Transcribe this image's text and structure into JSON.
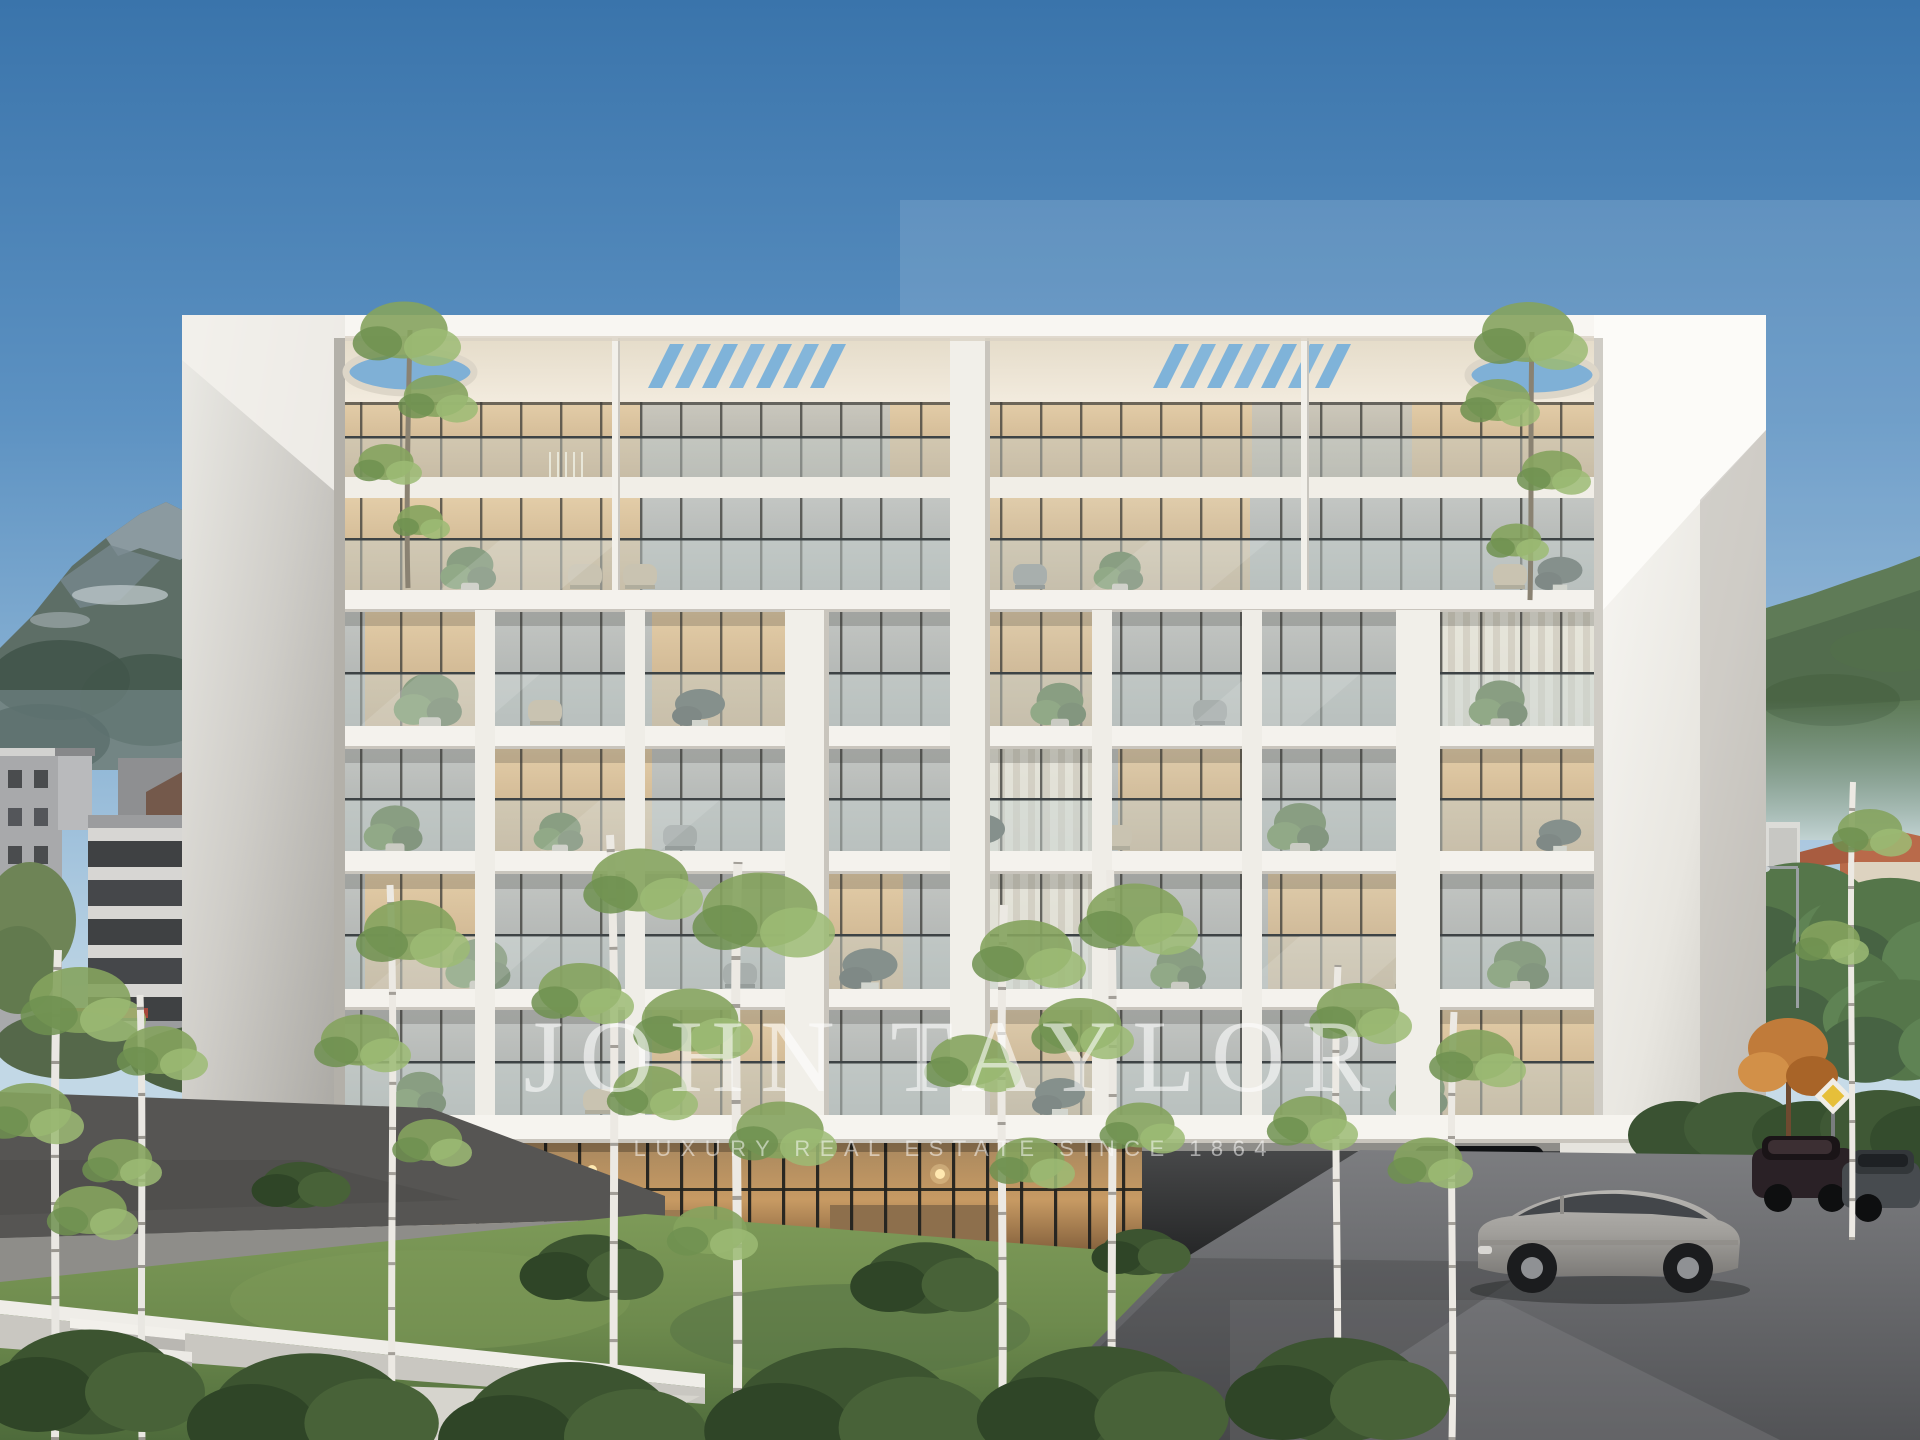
{
  "watermark": {
    "title": "JOHN TAYLOR",
    "tagline": "LUXURY REAL ESTATE SINCE 1864"
  },
  "scene": {
    "type": "architectural-rendering",
    "subject": "modern-white-apartment-building",
    "floors": "ground lobby + 4 balcony floors + duplex penthouse with slatted roof",
    "features": [
      "glass-balustrades",
      "round-roof-openings-with-trees",
      "roof-slat-skylights",
      "balcony-plants"
    ],
    "environment": [
      "blue-sky",
      "rocky-mountain-left",
      "green-mountain-right",
      "city-buildings-left",
      "red-roof-houses-right",
      "lawn",
      "birch-trees",
      "bushes",
      "hedge",
      "cobblestone-driveway",
      "concrete-stairs",
      "street-lamp"
    ],
    "vehicles": [
      "silver-sedan",
      "dark-suv-undercroft",
      "dark-suv-rear",
      "grey-estate-car"
    ],
    "road_sign": {
      "shape": "diamond",
      "color": "#e6bf3a"
    }
  },
  "palette": {
    "sky_top": "#3a74ab",
    "sky_horizon": "#c2d8e6",
    "building_white": "#f2efe9",
    "soffit_cream": "#ece4d4",
    "glass_warm": "#d8c2a2",
    "glass_cool": "#b9bcba",
    "balustrade_glass": "#c9d2d0",
    "lawn": "#6d8a4d",
    "bush_dark": "#3c5430",
    "mountain_left": "#5d6e66",
    "mountain_right": "#5f7b57",
    "driveway": "#6b6c6f",
    "hedge": "#3a5232",
    "autumn_tree": "#c07b3a",
    "sedan_silver": "#a8a6a2",
    "suv_dark": "#1a1c1e"
  }
}
